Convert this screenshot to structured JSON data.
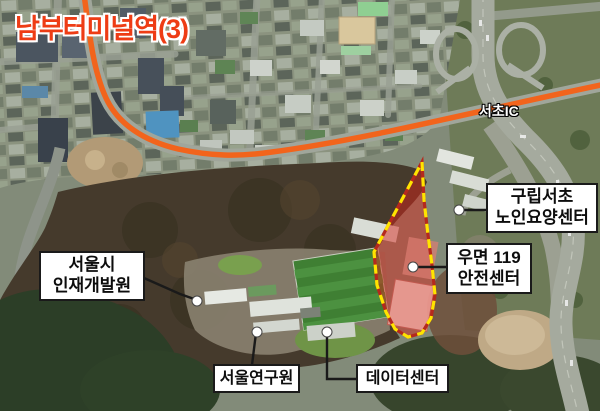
{
  "map": {
    "station_label": "남부터미널역(3)",
    "road_label": "서초IC",
    "callouts": {
      "senior_center": {
        "line1": "구립서초",
        "line2": "노인요양센터"
      },
      "fire_station": {
        "line1": "우면 119",
        "line2": "안전센터"
      },
      "hrd_institute": {
        "line1": "서울시",
        "line2": "인재개발원"
      },
      "seoul_institute": {
        "line1": "서울연구원"
      },
      "data_center": {
        "line1": "데이터센터"
      }
    },
    "colors": {
      "metro_line_3": "#f2641c",
      "station_label_text": "#ee3c15",
      "highlight_fill": "#d72319",
      "highlight_border": "#ffe400",
      "callout_border": "#1a1a1a",
      "callout_background": "#ffffff"
    }
  }
}
